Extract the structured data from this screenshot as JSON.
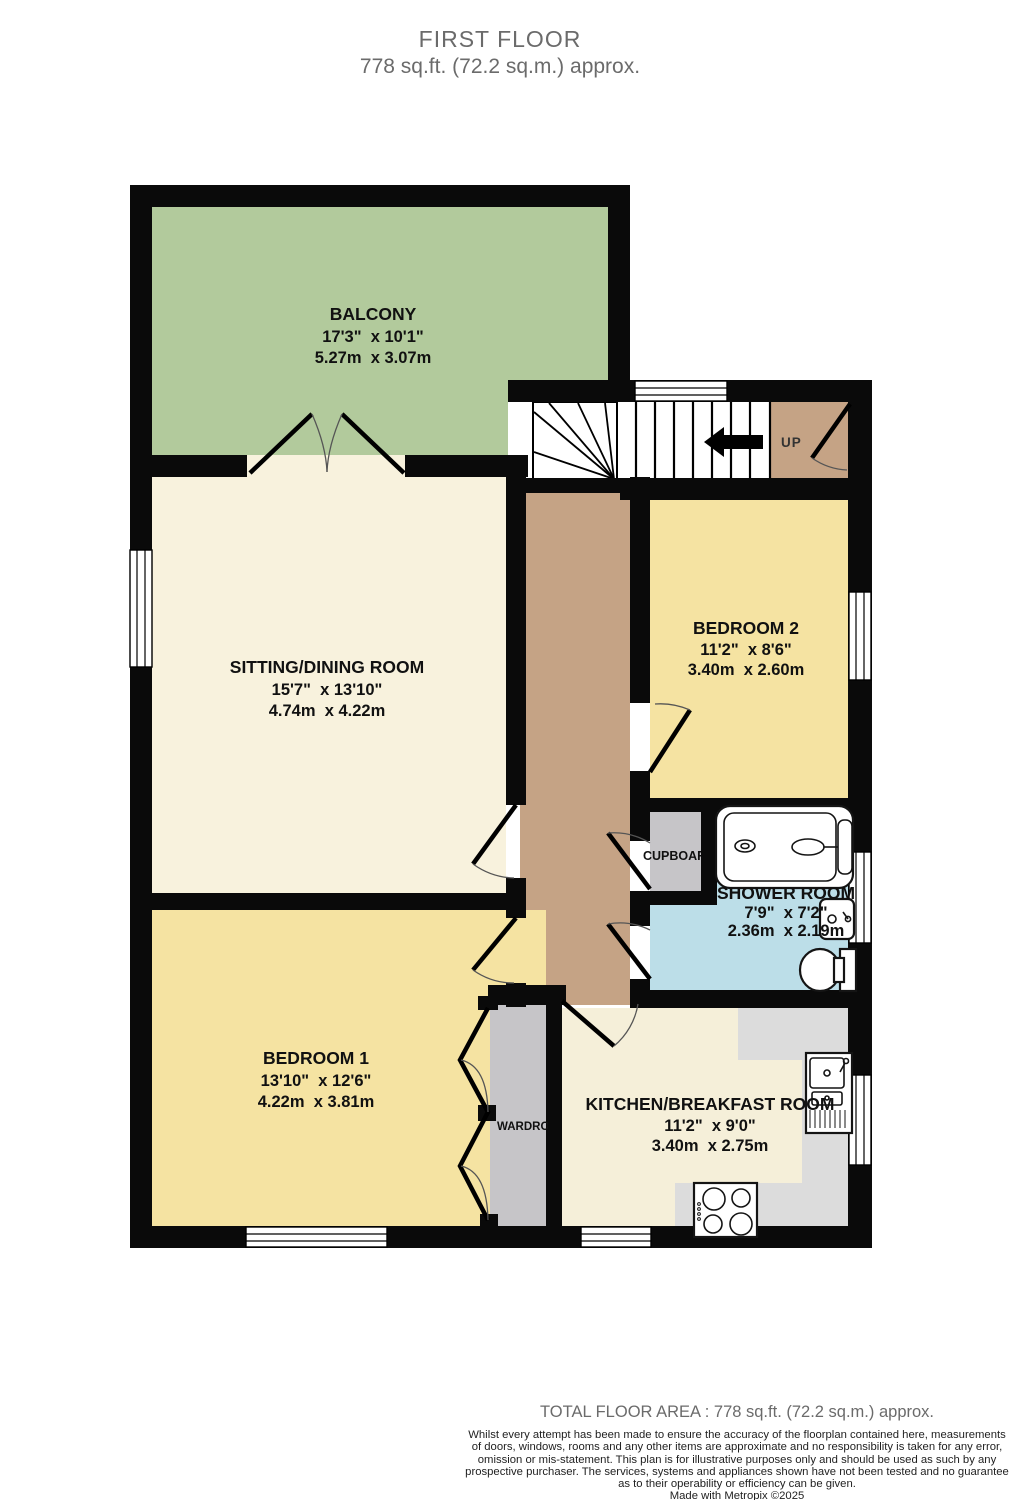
{
  "header": {
    "title": "FIRST FLOOR",
    "subtitle": "778 sq.ft. (72.2 sq.m.) approx."
  },
  "rooms": {
    "balcony": {
      "name": "BALCONY",
      "imperial": "17'3\"  x 10'1\"",
      "metric": "5.27m  x 3.07m"
    },
    "sitting": {
      "name": "SITTING/DINING ROOM",
      "imperial": "15'7\"  x 13'10\"",
      "metric": "4.74m  x 4.22m"
    },
    "bedroom2": {
      "name": "BEDROOM 2",
      "imperial": "11'2\"  x 8'6\"",
      "metric": "3.40m  x 2.60m"
    },
    "shower": {
      "name": "SHOWER ROOM",
      "imperial": "7'9\"  x 7'2\"",
      "metric": "2.36m  x 2.19m"
    },
    "bedroom1": {
      "name": "BEDROOM 1",
      "imperial": "13'10\"  x 12'6\"",
      "metric": "4.22m  x 3.81m"
    },
    "kitchen": {
      "name": "KITCHEN/BREAKFAST ROOM",
      "imperial": "11'2\"  x 9'0\"",
      "metric": "3.40m  x 2.75m"
    }
  },
  "labels": {
    "up": "UP",
    "cupboard": "CUPBOARD",
    "wardrobe": "WARDROBE"
  },
  "footer": {
    "total": "TOTAL FLOOR AREA : 778 sq.ft. (72.2 sq.m.) approx.",
    "disclaimer_lines": [
      "Whilst every attempt has been made to ensure the accuracy of the floorplan contained here, measurements",
      "of doors, windows, rooms and any other items are approximate and no responsibility is taken for any error,",
      "omission or mis-statement. This plan is for illustrative purposes only and should be used as such by any",
      "prospective purchaser. The services, systems and appliances shown have not been tested and no guarantee",
      "as to their operability or efficiency can be given."
    ],
    "credit": "Made with Metropix ©2025"
  },
  "colors": {
    "wall": "#0a0a0a",
    "balcony": "#b2ca9c",
    "sitting_room": "#f8f2dd",
    "bedroom": "#f5e3a2",
    "hallway": "#c5a385",
    "shower_room": "#bcdee8",
    "storage_gray": "#c6c5c8",
    "counter_gray": "#dcdcdc",
    "kitchen_floor": "#f5efd9",
    "title_text": "#6b6b6b",
    "label_text": "#111111"
  }
}
